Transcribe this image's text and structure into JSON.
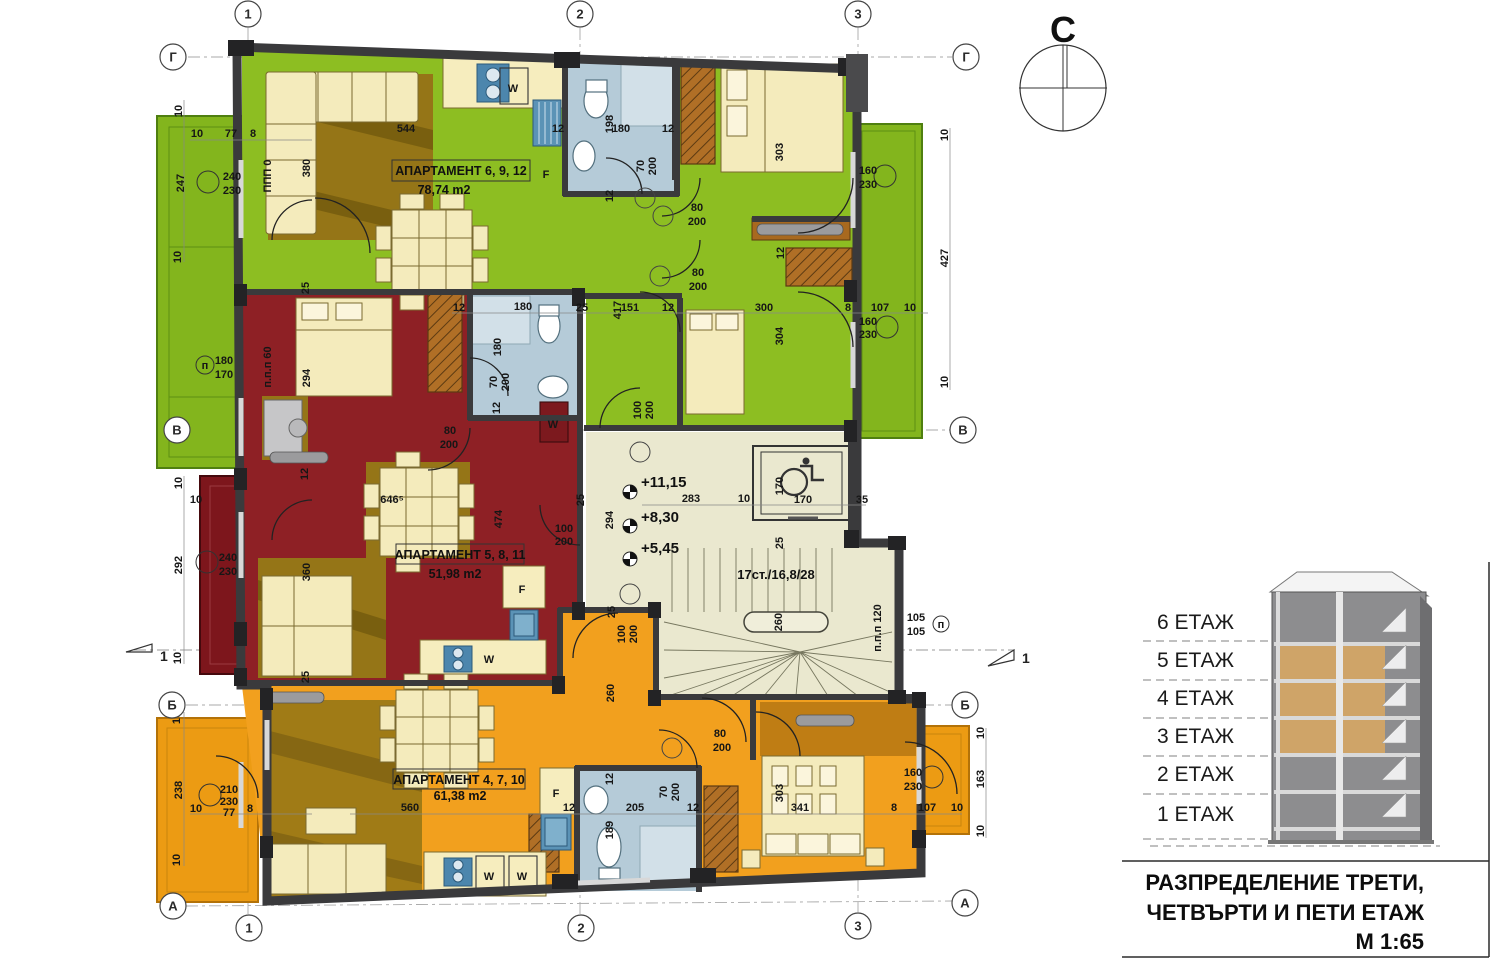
{
  "compass": {
    "label": "С"
  },
  "grid": {
    "top": [
      "1",
      "2",
      "3"
    ],
    "bottom": [
      "1",
      "2",
      "3"
    ],
    "left": [
      "Г",
      "В",
      "Б",
      "А"
    ],
    "right": [
      "Г",
      "В",
      "Б",
      "А"
    ]
  },
  "apartments": [
    {
      "name": "АПАРТАМЕНТ 6, 9, 12",
      "area": "78,74 m2"
    },
    {
      "name": "АПАРТАМЕНТ 5, 8, 11",
      "area": "51,98 m2"
    },
    {
      "name": "АПАРТАМЕНТ 4, 7, 10",
      "area": "61,38 m2"
    }
  ],
  "stairwell": {
    "levels": [
      "+11,15",
      "+8,30",
      "+5,45"
    ],
    "stair_label": "17ст./16,8/28"
  },
  "section_markers": {
    "left": "1",
    "right": "1"
  },
  "legend": {
    "floors": [
      "6 ЕТАЖ",
      "5 ЕТАЖ",
      "4 ЕТАЖ",
      "3 ЕТАЖ",
      "2 ЕТАЖ",
      "1 ЕТАЖ"
    ]
  },
  "title_block": {
    "line1": "РАЗПРЕДЕЛЕНИЕ ТРЕТИ,",
    "line2": "ЧЕТВЪРТИ И ПЕТИ ЕТАЖ",
    "scale": "М 1:65"
  },
  "appliances": [
    {
      "label": "W",
      "x": 513,
      "y": 88,
      "c": "#111111"
    },
    {
      "label": "F",
      "x": 546,
      "y": 174,
      "c": "#1f7a1f"
    },
    {
      "label": "W",
      "x": 553,
      "y": 424,
      "c": "#111111"
    },
    {
      "label": "F",
      "x": 522,
      "y": 589,
      "c": "#1f7a1f"
    },
    {
      "label": "W",
      "x": 489,
      "y": 659,
      "c": "#111111"
    },
    {
      "label": "F",
      "x": 556,
      "y": 793,
      "c": "#1f7a1f"
    },
    {
      "label": "W",
      "x": 489,
      "y": 876,
      "c": "#111111"
    },
    {
      "label": "W",
      "x": 522,
      "y": 876,
      "c": "#111111"
    }
  ],
  "colors": {
    "apartment_green": "#8dbe22",
    "apartment_red": "#8e2025",
    "apartment_orange": "#f2a01e",
    "hall": "#eae8cf",
    "wall": "#3a3a3c",
    "bath": "#b5cbd8",
    "legend_highlight": "#cfa468"
  },
  "dims": [
    {
      "t": "10",
      "x": 178,
      "y": 111,
      "r": -90
    },
    {
      "t": "10",
      "x": 197,
      "y": 133,
      "r": 0
    },
    {
      "t": "77",
      "x": 231,
      "y": 133,
      "r": 0
    },
    {
      "t": "8",
      "x": 253,
      "y": 133,
      "r": 0
    },
    {
      "t": "544",
      "x": 406,
      "y": 128,
      "r": 0
    },
    {
      "t": "12",
      "x": 558,
      "y": 128,
      "r": 0
    },
    {
      "t": "198",
      "x": 609,
      "y": 124,
      "r": -90
    },
    {
      "t": "180",
      "x": 621,
      "y": 128,
      "r": 0
    },
    {
      "t": "12",
      "x": 668,
      "y": 128,
      "r": 0
    },
    {
      "t": "247",
      "x": 180,
      "y": 183,
      "r": -90
    },
    {
      "t": "240",
      "x": 232,
      "y": 176,
      "r": 0
    },
    {
      "t": "230",
      "x": 232,
      "y": 190,
      "r": 0
    },
    {
      "t": "ППП 0",
      "x": 267,
      "y": 176,
      "r": -90,
      "s": 9
    },
    {
      "t": "380",
      "x": 306,
      "y": 168,
      "r": -90
    },
    {
      "t": "70",
      "x": 640,
      "y": 166,
      "r": -90
    },
    {
      "t": "200",
      "x": 652,
      "y": 166,
      "r": -90
    },
    {
      "t": "12",
      "x": 609,
      "y": 196,
      "r": -90
    },
    {
      "t": "80",
      "x": 697,
      "y": 207,
      "r": 0
    },
    {
      "t": "200",
      "x": 697,
      "y": 221,
      "r": 0
    },
    {
      "t": "160",
      "x": 868,
      "y": 170,
      "r": 0
    },
    {
      "t": "230",
      "x": 868,
      "y": 184,
      "r": 0
    },
    {
      "t": "303",
      "x": 779,
      "y": 152,
      "r": -90
    },
    {
      "t": "10",
      "x": 944,
      "y": 135,
      "r": -90
    },
    {
      "t": "427",
      "x": 944,
      "y": 258,
      "r": -90
    },
    {
      "t": "10",
      "x": 944,
      "y": 382,
      "r": -90
    },
    {
      "t": "10",
      "x": 177,
      "y": 257,
      "r": -90
    },
    {
      "t": "180",
      "x": 224,
      "y": 360,
      "r": 0
    },
    {
      "t": "170",
      "x": 224,
      "y": 374,
      "r": 0
    },
    {
      "t": "п.п.п 60",
      "x": 267,
      "y": 367,
      "r": -90,
      "s": 9
    },
    {
      "t": "294",
      "x": 306,
      "y": 378,
      "r": -90
    },
    {
      "t": "25",
      "x": 305,
      "y": 288,
      "r": -90
    },
    {
      "t": "80",
      "x": 698,
      "y": 272,
      "r": 0
    },
    {
      "t": "200",
      "x": 698,
      "y": 286,
      "r": 0
    },
    {
      "t": "12",
      "x": 780,
      "y": 253,
      "r": -90
    },
    {
      "t": "25",
      "x": 582,
      "y": 307,
      "r": 0
    },
    {
      "t": "417",
      "x": 617,
      "y": 310,
      "r": -90
    },
    {
      "t": "151",
      "x": 630,
      "y": 307,
      "r": 0
    },
    {
      "t": "12",
      "x": 668,
      "y": 307,
      "r": 0
    },
    {
      "t": "300",
      "x": 764,
      "y": 307,
      "r": 0
    },
    {
      "t": "8",
      "x": 848,
      "y": 307,
      "r": 0
    },
    {
      "t": "107",
      "x": 880,
      "y": 307,
      "r": 0
    },
    {
      "t": "10",
      "x": 910,
      "y": 307,
      "r": 0
    },
    {
      "t": "304",
      "x": 779,
      "y": 336,
      "r": -90
    },
    {
      "t": "160",
      "x": 868,
      "y": 321,
      "r": 0
    },
    {
      "t": "230",
      "x": 868,
      "y": 334,
      "r": 0
    },
    {
      "t": "100",
      "x": 637,
      "y": 410,
      "r": -90
    },
    {
      "t": "200",
      "x": 649,
      "y": 410,
      "r": -90
    },
    {
      "t": "12",
      "x": 459,
      "y": 307,
      "r": 0
    },
    {
      "t": "180",
      "x": 523,
      "y": 306,
      "r": 0
    },
    {
      "t": "180",
      "x": 497,
      "y": 347,
      "r": -90
    },
    {
      "t": "70",
      "x": 493,
      "y": 382,
      "r": -90
    },
    {
      "t": "200",
      "x": 505,
      "y": 382,
      "r": -90
    },
    {
      "t": "12",
      "x": 496,
      "y": 408,
      "r": -90
    },
    {
      "t": "80",
      "x": 450,
      "y": 430,
      "r": 0
    },
    {
      "t": "200",
      "x": 449,
      "y": 444,
      "r": 0
    },
    {
      "t": "12",
      "x": 304,
      "y": 474,
      "r": -90
    },
    {
      "t": "10",
      "x": 178,
      "y": 483,
      "r": -90
    },
    {
      "t": "10",
      "x": 196,
      "y": 499,
      "r": 0
    },
    {
      "t": "292",
      "x": 178,
      "y": 565,
      "r": -90
    },
    {
      "t": "240",
      "x": 228,
      "y": 557,
      "r": 0
    },
    {
      "t": "230",
      "x": 228,
      "y": 571,
      "r": 0
    },
    {
      "t": "360",
      "x": 306,
      "y": 572,
      "r": -90
    },
    {
      "t": "646⁵",
      "x": 392,
      "y": 499,
      "r": 0
    },
    {
      "t": "474",
      "x": 498,
      "y": 519,
      "r": -90
    },
    {
      "t": "25",
      "x": 580,
      "y": 500,
      "r": -90
    },
    {
      "t": "100",
      "x": 564,
      "y": 528,
      "r": 0
    },
    {
      "t": "200",
      "x": 564,
      "y": 541,
      "r": 0
    },
    {
      "t": "283",
      "x": 691,
      "y": 498,
      "r": 0
    },
    {
      "t": "10",
      "x": 744,
      "y": 498,
      "r": 0
    },
    {
      "t": "294",
      "x": 609,
      "y": 520,
      "r": -90
    },
    {
      "t": "170",
      "x": 779,
      "y": 486,
      "r": -90
    },
    {
      "t": "170",
      "x": 803,
      "y": 499,
      "r": 0
    },
    {
      "t": "35",
      "x": 862,
      "y": 499,
      "r": 0
    },
    {
      "t": "25",
      "x": 779,
      "y": 543,
      "r": -90
    },
    {
      "t": "260",
      "x": 778,
      "y": 622,
      "r": -90
    },
    {
      "t": "105",
      "x": 916,
      "y": 617,
      "r": 0
    },
    {
      "t": "105",
      "x": 916,
      "y": 631,
      "r": 0
    },
    {
      "t": "п.п.п 120",
      "x": 877,
      "y": 628,
      "r": -90,
      "s": 9
    },
    {
      "t": "25",
      "x": 611,
      "y": 612,
      "r": -90
    },
    {
      "t": "100",
      "x": 621,
      "y": 634,
      "r": -90
    },
    {
      "t": "200",
      "x": 633,
      "y": 634,
      "r": -90
    },
    {
      "t": "260",
      "x": 610,
      "y": 693,
      "r": -90
    },
    {
      "t": "80",
      "x": 720,
      "y": 733,
      "r": 0
    },
    {
      "t": "200",
      "x": 722,
      "y": 747,
      "r": 0
    },
    {
      "t": "10",
      "x": 177,
      "y": 658,
      "r": -90
    },
    {
      "t": "25",
      "x": 305,
      "y": 677,
      "r": -90
    },
    {
      "t": "10",
      "x": 176,
      "y": 718,
      "r": -90
    },
    {
      "t": "238",
      "x": 178,
      "y": 790,
      "r": -90
    },
    {
      "t": "210",
      "x": 229,
      "y": 789,
      "r": 0
    },
    {
      "t": "230",
      "x": 229,
      "y": 801,
      "r": 0
    },
    {
      "t": "77",
      "x": 229,
      "y": 812,
      "r": 0
    },
    {
      "t": "10",
      "x": 196,
      "y": 808,
      "r": 0
    },
    {
      "t": "8",
      "x": 250,
      "y": 808,
      "r": 0
    },
    {
      "t": "10",
      "x": 176,
      "y": 860,
      "r": -90
    },
    {
      "t": "560",
      "x": 410,
      "y": 807,
      "r": 0
    },
    {
      "t": "12",
      "x": 569,
      "y": 807,
      "r": 0
    },
    {
      "t": "205",
      "x": 635,
      "y": 807,
      "r": 0
    },
    {
      "t": "12",
      "x": 693,
      "y": 807,
      "r": 0
    },
    {
      "t": "70",
      "x": 663,
      "y": 792,
      "r": -90
    },
    {
      "t": "200",
      "x": 675,
      "y": 792,
      "r": -90
    },
    {
      "t": "12",
      "x": 609,
      "y": 779,
      "r": -90
    },
    {
      "t": "189",
      "x": 609,
      "y": 830,
      "r": -90
    },
    {
      "t": "303",
      "x": 779,
      "y": 793,
      "r": -90
    },
    {
      "t": "341",
      "x": 800,
      "y": 807,
      "r": 0
    },
    {
      "t": "160",
      "x": 913,
      "y": 772,
      "r": 0
    },
    {
      "t": "230",
      "x": 913,
      "y": 786,
      "r": 0
    },
    {
      "t": "8",
      "x": 894,
      "y": 807,
      "r": 0
    },
    {
      "t": "107",
      "x": 927,
      "y": 807,
      "r": 0
    },
    {
      "t": "10",
      "x": 957,
      "y": 807,
      "r": 0
    },
    {
      "t": "10",
      "x": 980,
      "y": 733,
      "r": -90
    },
    {
      "t": "163",
      "x": 980,
      "y": 779,
      "r": -90
    },
    {
      "t": "10",
      "x": 980,
      "y": 831,
      "r": -90
    },
    {
      "t": "п",
      "x": 205,
      "y": 365,
      "r": 0,
      "s": 10
    },
    {
      "t": "п",
      "x": 941,
      "y": 624,
      "r": 0,
      "s": 9
    }
  ]
}
